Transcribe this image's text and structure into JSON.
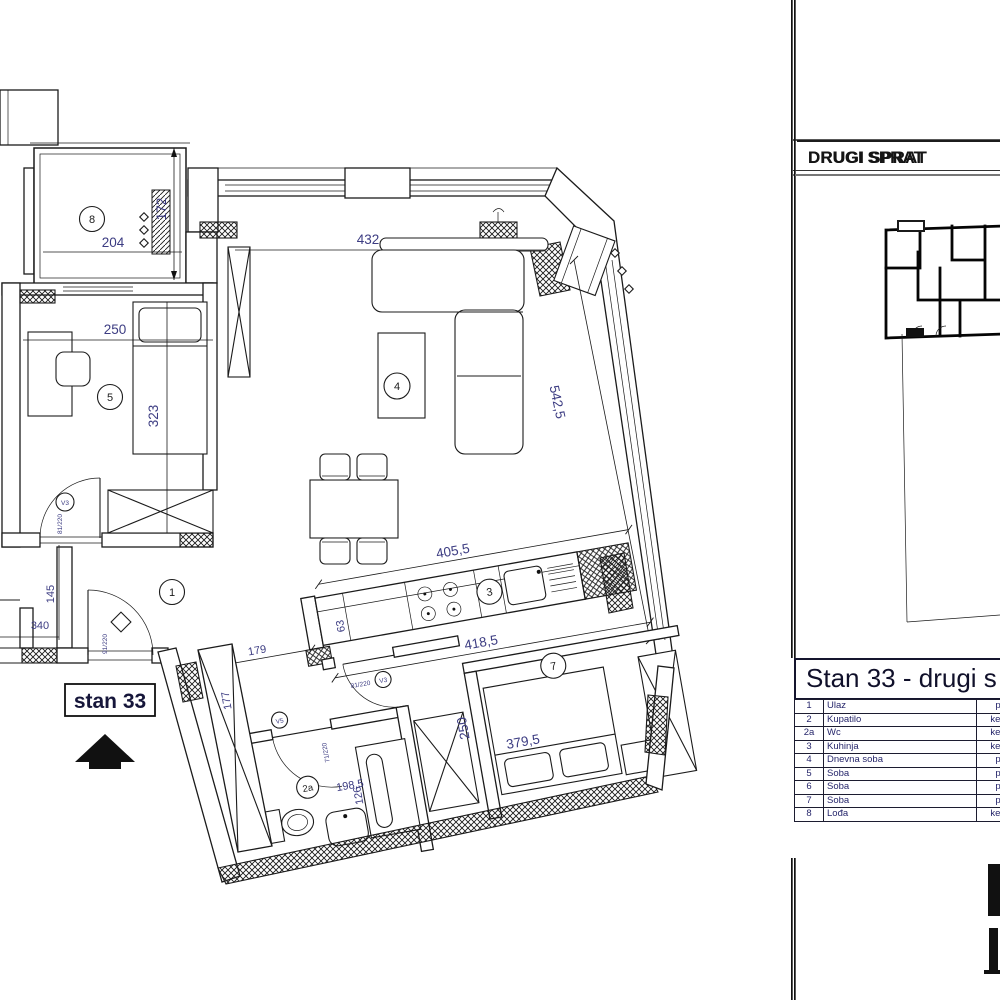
{
  "panel": {
    "floor_title": "DRUGI SPRAT",
    "table": {
      "title": "Stan 33 - drugi s",
      "rows": [
        {
          "num": "1",
          "name": "Ulaz",
          "finish": "p"
        },
        {
          "num": "2",
          "name": "Kupatilo",
          "finish": "ker."
        },
        {
          "num": "2a",
          "name": "Wc",
          "finish": "ker."
        },
        {
          "num": "3",
          "name": "Kuhinja",
          "finish": "ker."
        },
        {
          "num": "4",
          "name": "Dnevna soba",
          "finish": "p"
        },
        {
          "num": "5",
          "name": "Soba",
          "finish": "p"
        },
        {
          "num": "6",
          "name": "Soba",
          "finish": "p"
        },
        {
          "num": "7",
          "name": "Soba",
          "finish": "p"
        },
        {
          "num": "8",
          "name": "Lođa",
          "finish": "ker."
        }
      ]
    }
  },
  "plan": {
    "apartment_label": "stan 33",
    "rooms": {
      "entry": "1",
      "wc": "2a",
      "kitchen": "3",
      "living_room": "4",
      "room5": "5",
      "room7": "7",
      "loggia": "8"
    },
    "dimensions": {
      "loggia_width": "204",
      "loggia_depth": "172",
      "room5_width": "250",
      "room5_depth": "323",
      "living_width": "432",
      "living_wall": "542,5",
      "kitchen_width": "405,5",
      "corridor_width": "418,5",
      "counter_depth": "63",
      "entry_height": "145",
      "entry_width": "340",
      "hall_width": "179",
      "closet_depth": "177",
      "room7_depth": "250",
      "room7_width": "379,5",
      "bathroom_width": "198,5",
      "bathroom_depth": "126"
    },
    "doors": {
      "entry_size": "91/220",
      "room5_size": "81/220",
      "room5_mark": "V3",
      "hall_size": "81/220",
      "hall_mark": "V3",
      "bathroom_size": "71/220",
      "bathroom_mark": "V5"
    }
  },
  "colors": {
    "line": "#1b1b1b",
    "dim_text": "#3c3c82",
    "table_text": "#26266b",
    "title_text": "#10102a"
  }
}
